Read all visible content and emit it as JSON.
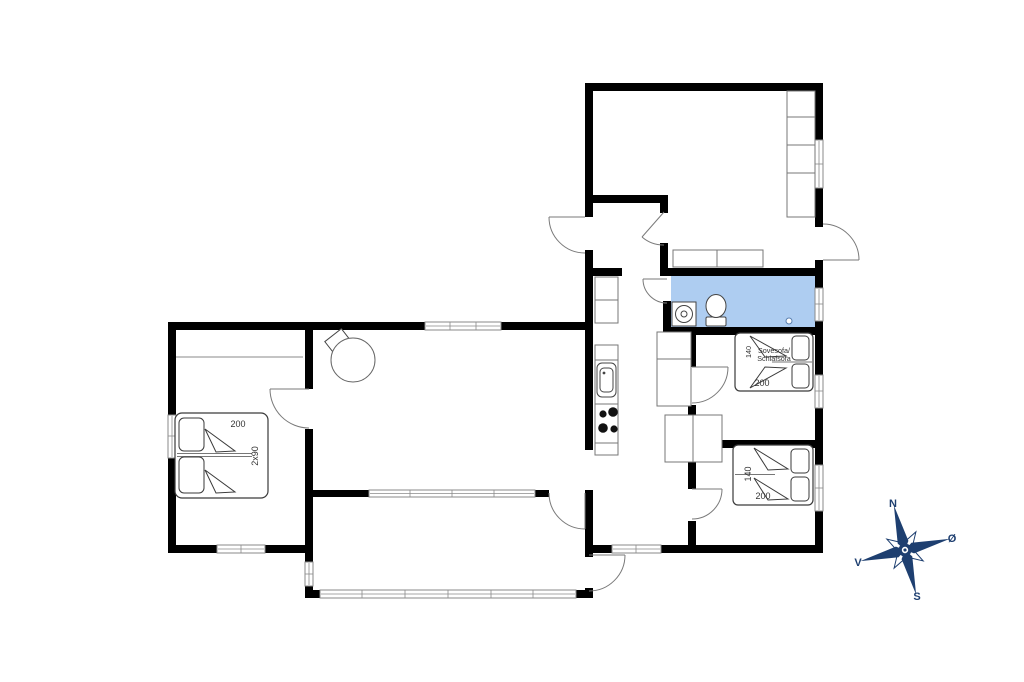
{
  "floorplan": {
    "title": "house-floor-plan",
    "rooms": {
      "bedroom_left": {
        "bed_length": "200",
        "bed_width": "2x90"
      },
      "lounge_room": {
        "bed_width": "140",
        "sofa_label_line1": "Sovesofa/",
        "sofa_label_line2": "Schlafsofa",
        "bed_length": "200"
      },
      "bedroom_right": {
        "bed_width": "140",
        "bed_length": "200"
      }
    },
    "compass": {
      "north_label": "N",
      "east_label": "Ø",
      "south_label": "S",
      "west_label": "V"
    },
    "colors": {
      "wall": "#000000",
      "bathroom_highlight": "#aecdf1",
      "compass_navy": "#1e3f70"
    }
  }
}
